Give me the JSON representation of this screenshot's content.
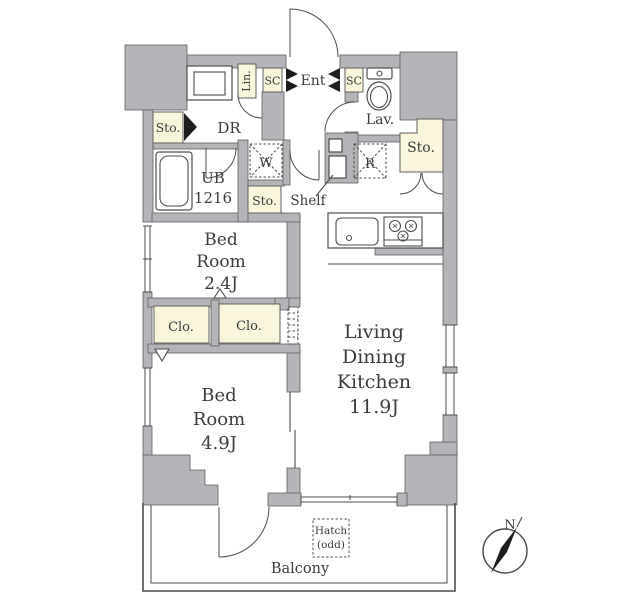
{
  "title": "Apartment floor plan (1LDK + S)",
  "colors": {
    "wall": "#b5b4b8",
    "storage_fill": "#f8f5da",
    "line": "#4d4d4d",
    "text": "#3c3c3c",
    "background": "#ffffff"
  },
  "labels": {
    "linen_closet": "Lin.",
    "shoe_closet_left": "SC",
    "entrance": "Ent",
    "shoe_closet_right": "SC",
    "lavatory": "Lav.",
    "storage_left": "Sto.",
    "storage_middle": "Sto.",
    "storage_right": "Sto.",
    "dressing_room": "DR",
    "washer": "W",
    "refrigerator": "R",
    "unit_bath_line1": "UB",
    "unit_bath_line2": "1216",
    "shelf": "Shelf",
    "closet_left": "Clo.",
    "closet_right": "Clo.",
    "hatch_line1": "Hatch",
    "hatch_line2": "(odd)",
    "balcony": "Balcony",
    "compass_north": "N"
  },
  "rooms": {
    "bedroom_small": [
      "Bed",
      "Room",
      "2.4J"
    ],
    "bedroom_large": [
      "Bed",
      "Room",
      "4.9J"
    ],
    "ldk": [
      "Living",
      "Dining",
      "Kitchen",
      "11.9J"
    ]
  }
}
